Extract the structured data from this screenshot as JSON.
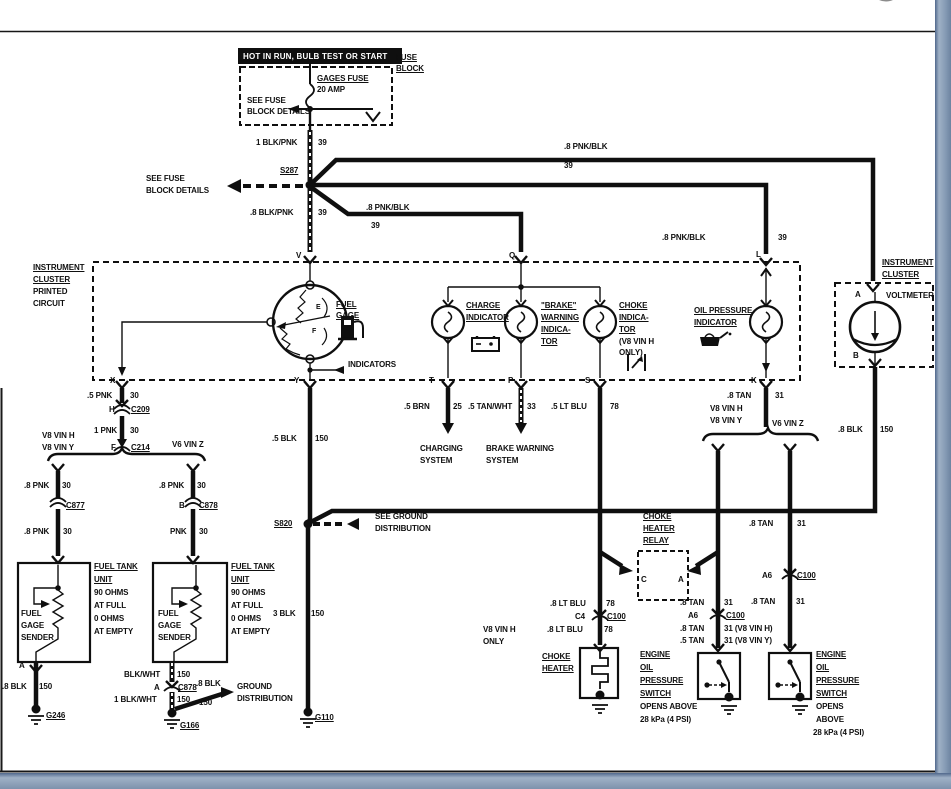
{
  "window": {
    "close_icon": "x-close-circle",
    "frame_accent_color": "#7d92ac",
    "frame_line_color": "#51688c"
  },
  "diagram": {
    "title": "HOT IN RUN, BULB TEST OR START",
    "ink_color": "#0f0f0f",
    "labels": [
      {
        "n": "banner-title",
        "t": "HOT IN RUN, BULB TEST OR START",
        "x": 243,
        "y": 52,
        "inv": true
      },
      {
        "n": "fuse-block-1",
        "t": "FUSE",
        "x": 396,
        "y": 53,
        "ul": true
      },
      {
        "n": "fuse-block-2",
        "t": "BLOCK",
        "x": 396,
        "y": 64,
        "ul": true
      },
      {
        "n": "gages-fuse",
        "t": "GAGES FUSE",
        "x": 317,
        "y": 74,
        "ul": true
      },
      {
        "n": "gages-fuse-amp",
        "t": "20 AMP",
        "x": 317,
        "y": 85
      },
      {
        "n": "see-fuse-a1",
        "t": "SEE FUSE",
        "x": 247,
        "y": 96
      },
      {
        "n": "see-fuse-a2",
        "t": "BLOCK DETAILS",
        "x": 247,
        "y": 107
      },
      {
        "n": "w-1blkpnk",
        "t": "1 BLK/PNK",
        "x": 256,
        "y": 138
      },
      {
        "n": "w-1blkpnk-ckt",
        "t": "39",
        "x": 318,
        "y": 138
      },
      {
        "n": "splice-s287",
        "t": "S287",
        "x": 280,
        "y": 166,
        "ul": true
      },
      {
        "n": "see-fuse-b1",
        "t": "SEE FUSE",
        "x": 146,
        "y": 174
      },
      {
        "n": "see-fuse-b2",
        "t": "BLOCK DETAILS",
        "x": 146,
        "y": 186
      },
      {
        "n": "w-8blkpnk",
        "t": ".8 BLK/PNK",
        "x": 250,
        "y": 208
      },
      {
        "n": "w-8blkpnk-ckt",
        "t": "39",
        "x": 318,
        "y": 208
      },
      {
        "n": "w-8pnkblk-top",
        "t": ".8 PNK/BLK",
        "x": 564,
        "y": 142
      },
      {
        "n": "w-8pnkblk-top-ckt",
        "t": "39",
        "x": 564,
        "y": 161
      },
      {
        "n": "w-8pnkblk-q",
        "t": ".8 PNK/BLK",
        "x": 366,
        "y": 203
      },
      {
        "n": "w-8pnkblk-q-ckt",
        "t": "39",
        "x": 371,
        "y": 221
      },
      {
        "n": "w-8pnkblk-l",
        "t": ".8 PNK/BLK",
        "x": 662,
        "y": 233
      },
      {
        "n": "w-8pnkblk-l-ckt",
        "t": "39",
        "x": 778,
        "y": 233
      },
      {
        "n": "ic-1",
        "t": "INSTRUMENT",
        "x": 33,
        "y": 263,
        "ul": true
      },
      {
        "n": "ic-2",
        "t": "CLUSTER",
        "x": 33,
        "y": 275,
        "ul": true
      },
      {
        "n": "ic-3",
        "t": "PRINTED",
        "x": 33,
        "y": 287
      },
      {
        "n": "ic-4",
        "t": "CIRCUIT",
        "x": 33,
        "y": 299
      },
      {
        "n": "term-v",
        "t": "V",
        "x": 296,
        "y": 251
      },
      {
        "n": "term-q",
        "t": "Q",
        "x": 509,
        "y": 251
      },
      {
        "n": "term-l",
        "t": "L",
        "x": 756,
        "y": 250
      },
      {
        "n": "fuel-gage-1",
        "t": "FUEL",
        "x": 336,
        "y": 300,
        "ul": true
      },
      {
        "n": "fuel-gage-2",
        "t": "GAGE",
        "x": 336,
        "y": 311,
        "ul": true
      },
      {
        "n": "gauge-e",
        "t": "E",
        "x": 316,
        "y": 303,
        "fs": 7
      },
      {
        "n": "gauge-f",
        "t": "F",
        "x": 312,
        "y": 327,
        "fs": 7
      },
      {
        "n": "indicators",
        "t": "INDICATORS",
        "x": 348,
        "y": 360
      },
      {
        "n": "charge-1",
        "t": "CHARGE",
        "x": 466,
        "y": 301,
        "ul": true
      },
      {
        "n": "charge-2",
        "t": "INDICATOR",
        "x": 466,
        "y": 313,
        "ul": true
      },
      {
        "n": "brake-1",
        "t": "\"BRAKE\"",
        "x": 541,
        "y": 301,
        "ul": true
      },
      {
        "n": "brake-2",
        "t": "WARNING",
        "x": 541,
        "y": 313,
        "ul": true
      },
      {
        "n": "brake-3",
        "t": "INDICA-",
        "x": 541,
        "y": 325,
        "ul": true
      },
      {
        "n": "brake-4",
        "t": "TOR",
        "x": 541,
        "y": 337,
        "ul": true
      },
      {
        "n": "choke-1",
        "t": "CHOKE",
        "x": 619,
        "y": 301,
        "ul": true
      },
      {
        "n": "choke-2",
        "t": "INDICA-",
        "x": 619,
        "y": 313,
        "ul": true
      },
      {
        "n": "choke-3",
        "t": "TOR",
        "x": 619,
        "y": 325,
        "ul": true
      },
      {
        "n": "choke-4",
        "t": "(V8 VIN H",
        "x": 619,
        "y": 337
      },
      {
        "n": "choke-5",
        "t": "ONLY)",
        "x": 619,
        "y": 348
      },
      {
        "n": "oilind-1",
        "t": "OIL PRESSURE",
        "x": 694,
        "y": 306,
        "ul": true
      },
      {
        "n": "oilind-2",
        "t": "INDICATOR",
        "x": 694,
        "y": 318,
        "ul": true
      },
      {
        "n": "ic-right-1",
        "t": "INSTRUMENT",
        "x": 882,
        "y": 258,
        "ul": true
      },
      {
        "n": "ic-right-2",
        "t": "CLUSTER",
        "x": 882,
        "y": 270,
        "ul": true
      },
      {
        "n": "volt-a",
        "t": "A",
        "x": 855,
        "y": 290
      },
      {
        "n": "voltmeter",
        "t": "VOLTMETER",
        "x": 886,
        "y": 291
      },
      {
        "n": "volt-b",
        "t": "B",
        "x": 853,
        "y": 351
      },
      {
        "n": "term-x",
        "t": "X",
        "x": 110,
        "y": 376
      },
      {
        "n": "term-y",
        "t": "Y",
        "x": 294,
        "y": 376
      },
      {
        "n": "term-t",
        "t": "T",
        "x": 429,
        "y": 376
      },
      {
        "n": "term-p",
        "t": "P",
        "x": 508,
        "y": 376
      },
      {
        "n": "term-s",
        "t": "S",
        "x": 585,
        "y": 376
      },
      {
        "n": "term-k",
        "t": "K",
        "x": 751,
        "y": 376
      },
      {
        "n": "w-5pnk",
        "t": ".5 PNK",
        "x": 87,
        "y": 391
      },
      {
        "n": "w-5pnk-ckt",
        "t": "30",
        "x": 130,
        "y": 391
      },
      {
        "n": "conn-h",
        "t": "H",
        "x": 109,
        "y": 405
      },
      {
        "n": "conn-c209",
        "t": "C209",
        "x": 131,
        "y": 405,
        "ul": true
      },
      {
        "n": "w-1pnk",
        "t": "1 PNK",
        "x": 94,
        "y": 426
      },
      {
        "n": "w-1pnk-ckt",
        "t": "30",
        "x": 130,
        "y": 426
      },
      {
        "n": "vin-l1",
        "t": "V8 VIN H",
        "x": 42,
        "y": 431
      },
      {
        "n": "vin-l2",
        "t": "V8 VIN Y",
        "x": 42,
        "y": 443
      },
      {
        "n": "conn-f",
        "t": "F",
        "x": 111,
        "y": 443
      },
      {
        "n": "conn-c214",
        "t": "C214",
        "x": 131,
        "y": 443,
        "ul": true
      },
      {
        "n": "vin-l3",
        "t": "V6 VIN Z",
        "x": 172,
        "y": 440
      },
      {
        "n": "w-8pnk-a",
        "t": ".8 PNK",
        "x": 24,
        "y": 481
      },
      {
        "n": "w-8pnk-a-ckt",
        "t": "30",
        "x": 62,
        "y": 481
      },
      {
        "n": "conn-c877",
        "t": "C877",
        "x": 66,
        "y": 501,
        "ul": true
      },
      {
        "n": "w-8pnk-b",
        "t": ".8 PNK",
        "x": 159,
        "y": 481
      },
      {
        "n": "w-8pnk-b-ckt",
        "t": "30",
        "x": 197,
        "y": 481
      },
      {
        "n": "conn-c878-b",
        "t": "B",
        "x": 179,
        "y": 501
      },
      {
        "n": "conn-c878",
        "t": "C878",
        "x": 199,
        "y": 501,
        "ul": true
      },
      {
        "n": "w-8pnk-c",
        "t": ".8 PNK",
        "x": 24,
        "y": 527
      },
      {
        "n": "w-8pnk-c-ckt",
        "t": "30",
        "x": 63,
        "y": 527
      },
      {
        "n": "w-pnk",
        "t": "PNK",
        "x": 170,
        "y": 527
      },
      {
        "n": "w-pnk-ckt",
        "t": "30",
        "x": 199,
        "y": 527
      },
      {
        "n": "ft1-1",
        "t": "FUEL TANK",
        "x": 94,
        "y": 562,
        "ul": true
      },
      {
        "n": "ft1-2",
        "t": "UNIT",
        "x": 94,
        "y": 575,
        "ul": true
      },
      {
        "n": "ft1-3",
        "t": "90 OHMS",
        "x": 94,
        "y": 588
      },
      {
        "n": "ft1-4",
        "t": "AT FULL",
        "x": 94,
        "y": 601
      },
      {
        "n": "ft1-5",
        "t": "0 OHMS",
        "x": 94,
        "y": 614
      },
      {
        "n": "ft1-6",
        "t": "AT EMPTY",
        "x": 94,
        "y": 627
      },
      {
        "n": "sender1-1",
        "t": "FUEL",
        "x": 21,
        "y": 609
      },
      {
        "n": "sender1-2",
        "t": "GAGE",
        "x": 21,
        "y": 621
      },
      {
        "n": "sender1-3",
        "t": "SENDER",
        "x": 21,
        "y": 633
      },
      {
        "n": "ft2-1",
        "t": "FUEL TANK",
        "x": 231,
        "y": 562,
        "ul": true
      },
      {
        "n": "ft2-2",
        "t": "UNIT",
        "x": 231,
        "y": 575,
        "ul": true
      },
      {
        "n": "ft2-3",
        "t": "90 OHMS",
        "x": 231,
        "y": 588
      },
      {
        "n": "ft2-4",
        "t": "AT FULL",
        "x": 231,
        "y": 601
      },
      {
        "n": "ft2-5",
        "t": "0 OHMS",
        "x": 231,
        "y": 614
      },
      {
        "n": "ft2-6",
        "t": "AT EMPTY",
        "x": 231,
        "y": 627
      },
      {
        "n": "sender2-1",
        "t": "FUEL",
        "x": 158,
        "y": 609
      },
      {
        "n": "sender2-2",
        "t": "GAGE",
        "x": 158,
        "y": 621
      },
      {
        "n": "sender2-3",
        "t": "SENDER",
        "x": 158,
        "y": 633
      },
      {
        "n": "term-a1",
        "t": "A",
        "x": 19,
        "y": 661
      },
      {
        "n": "w-8blk-l",
        "t": ".8 BLK",
        "x": 2,
        "y": 682
      },
      {
        "n": "w-8blk-l-ckt",
        "t": "150",
        "x": 39,
        "y": 682
      },
      {
        "n": "gnd-g246",
        "t": "G246",
        "x": 46,
        "y": 711,
        "ul": true
      },
      {
        "n": "w-blkwht",
        "t": "BLK/WHT",
        "x": 124,
        "y": 670
      },
      {
        "n": "w-blkwht-ckt",
        "t": "150",
        "x": 177,
        "y": 670
      },
      {
        "n": "conn-c878b-a",
        "t": "A",
        "x": 154,
        "y": 683
      },
      {
        "n": "conn-c878b",
        "t": "C878",
        "x": 178,
        "y": 683,
        "ul": true
      },
      {
        "n": "w-1blkwht",
        "t": "1 BLK/WHT",
        "x": 114,
        "y": 695
      },
      {
        "n": "w-1blkwht-ckt",
        "t": "150",
        "x": 177,
        "y": 695
      },
      {
        "n": "w-8blk-diag",
        "t": ".8 BLK",
        "x": 196,
        "y": 679
      },
      {
        "n": "w-8blk-diag-ckt",
        "t": "150",
        "x": 199,
        "y": 698
      },
      {
        "n": "gnd-dist-1",
        "t": "GROUND",
        "x": 237,
        "y": 682
      },
      {
        "n": "gnd-dist-2",
        "t": "DISTRIBUTION",
        "x": 237,
        "y": 694
      },
      {
        "n": "gnd-g166",
        "t": "G166",
        "x": 180,
        "y": 721,
        "ul": true
      },
      {
        "n": "w-5blk",
        "t": ".5 BLK",
        "x": 272,
        "y": 434
      },
      {
        "n": "w-5blk-ckt",
        "t": "150",
        "x": 315,
        "y": 434
      },
      {
        "n": "splice-s820",
        "t": "S820",
        "x": 274,
        "y": 519,
        "ul": true
      },
      {
        "n": "see-gnd-1",
        "t": "SEE GROUND",
        "x": 375,
        "y": 512
      },
      {
        "n": "see-gnd-2",
        "t": "DISTRIBUTION",
        "x": 375,
        "y": 524
      },
      {
        "n": "w-3blk",
        "t": "3 BLK",
        "x": 273,
        "y": 609
      },
      {
        "n": "w-3blk-ckt",
        "t": "150",
        "x": 311,
        "y": 609
      },
      {
        "n": "gnd-g110",
        "t": "G110",
        "x": 315,
        "y": 713,
        "ul": true
      },
      {
        "n": "w-5brn",
        "t": ".5 BRN",
        "x": 404,
        "y": 402
      },
      {
        "n": "w-5brn-ckt",
        "t": "25",
        "x": 453,
        "y": 402
      },
      {
        "n": "charging-1",
        "t": "CHARGING",
        "x": 420,
        "y": 444
      },
      {
        "n": "charging-2",
        "t": "SYSTEM",
        "x": 420,
        "y": 456
      },
      {
        "n": "w-5tanwht",
        "t": ".5 TAN/WHT",
        "x": 468,
        "y": 402
      },
      {
        "n": "w-5tanwht-ckt",
        "t": "33",
        "x": 527,
        "y": 402
      },
      {
        "n": "brakesys-1",
        "t": "BRAKE WARNING",
        "x": 486,
        "y": 444
      },
      {
        "n": "brakesys-2",
        "t": "SYSTEM",
        "x": 486,
        "y": 456
      },
      {
        "n": "w-5ltblu",
        "t": ".5 LT BLU",
        "x": 551,
        "y": 402
      },
      {
        "n": "w-5ltblu-ckt",
        "t": "78",
        "x": 610,
        "y": 402
      },
      {
        "n": "w-8tan-k",
        "t": ".8 TAN",
        "x": 727,
        "y": 391
      },
      {
        "n": "w-8tan-k-ckt",
        "t": "31",
        "x": 775,
        "y": 391
      },
      {
        "n": "vin-r1",
        "t": "V8 VIN H",
        "x": 710,
        "y": 404
      },
      {
        "n": "vin-r2",
        "t": "V8 VIN Y",
        "x": 710,
        "y": 416
      },
      {
        "n": "vin-r3",
        "t": "V6 VIN Z",
        "x": 772,
        "y": 419
      },
      {
        "n": "w-8blk-volt",
        "t": ".8 BLK",
        "x": 838,
        "y": 425
      },
      {
        "n": "w-8blk-volt-ckt",
        "t": "150",
        "x": 880,
        "y": 425
      },
      {
        "n": "w-8tan-r1",
        "t": ".8 TAN",
        "x": 749,
        "y": 519
      },
      {
        "n": "w-8tan-r1-ckt",
        "t": "31",
        "x": 797,
        "y": 519
      },
      {
        "n": "relay-1",
        "t": "CHOKE",
        "x": 643,
        "y": 512,
        "ul": true
      },
      {
        "n": "relay-2",
        "t": "HEATER",
        "x": 643,
        "y": 524,
        "ul": true
      },
      {
        "n": "relay-3",
        "t": "RELAY",
        "x": 643,
        "y": 536,
        "ul": true
      },
      {
        "n": "relay-c",
        "t": "C",
        "x": 641,
        "y": 575
      },
      {
        "n": "relay-a",
        "t": "A",
        "x": 678,
        "y": 575
      },
      {
        "n": "w-8ltblu-1",
        "t": ".8 LT BLU",
        "x": 550,
        "y": 599
      },
      {
        "n": "w-8ltblu-1-ckt",
        "t": "78",
        "x": 606,
        "y": 599
      },
      {
        "n": "conn-c4",
        "t": "C4",
        "x": 575,
        "y": 612
      },
      {
        "n": "conn-c100-c4",
        "t": "C100",
        "x": 607,
        "y": 612,
        "ul": true
      },
      {
        "n": "w-8ltblu-2",
        "t": ".8 LT BLU",
        "x": 547,
        "y": 625
      },
      {
        "n": "w-8ltblu-2-ckt",
        "t": "78",
        "x": 604,
        "y": 625
      },
      {
        "n": "v8only-1",
        "t": "V8 VIN H",
        "x": 483,
        "y": 625
      },
      {
        "n": "v8only-2",
        "t": "ONLY",
        "x": 483,
        "y": 637
      },
      {
        "n": "heater-1",
        "t": "CHOKE",
        "x": 542,
        "y": 652,
        "ul": true
      },
      {
        "n": "heater-2",
        "t": "HEATER",
        "x": 542,
        "y": 664,
        "ul": true
      },
      {
        "n": "w-8tan-m1",
        "t": ".8 TAN",
        "x": 680,
        "y": 598
      },
      {
        "n": "w-8tan-m1-ckt",
        "t": "31",
        "x": 724,
        "y": 598
      },
      {
        "n": "conn-a6-m",
        "t": "A6",
        "x": 688,
        "y": 611
      },
      {
        "n": "conn-c100-m",
        "t": "C100",
        "x": 726,
        "y": 611,
        "ul": true
      },
      {
        "n": "w-8tan-m2",
        "t": ".8 TAN",
        "x": 680,
        "y": 624
      },
      {
        "n": "w-8tan-m2-ckt",
        "t": "31 (V8 VIN H)",
        "x": 724,
        "y": 624
      },
      {
        "n": "w-5tan-m",
        "t": ".5 TAN",
        "x": 680,
        "y": 636
      },
      {
        "n": "w-5tan-m-ckt",
        "t": "31 (V8 VIN Y)",
        "x": 724,
        "y": 636
      },
      {
        "n": "conn-a6-r",
        "t": "A6",
        "x": 762,
        "y": 571
      },
      {
        "n": "conn-c100-r",
        "t": "C100",
        "x": 797,
        "y": 571,
        "ul": true
      },
      {
        "n": "w-8tan-r2",
        "t": ".8 TAN",
        "x": 751,
        "y": 597
      },
      {
        "n": "w-8tan-r2-ckt",
        "t": "31",
        "x": 796,
        "y": 597
      },
      {
        "n": "sw1-1",
        "t": "ENGINE",
        "x": 640,
        "y": 650,
        "ul": true
      },
      {
        "n": "sw1-2",
        "t": "OIL",
        "x": 640,
        "y": 663,
        "ul": true
      },
      {
        "n": "sw1-3",
        "t": "PRESSURE",
        "x": 640,
        "y": 676,
        "ul": true
      },
      {
        "n": "sw1-4",
        "t": "SWITCH",
        "x": 640,
        "y": 689,
        "ul": true
      },
      {
        "n": "sw1-5",
        "t": "OPENS ABOVE",
        "x": 640,
        "y": 702
      },
      {
        "n": "sw1-6",
        "t": "28 kPa (4 PSI)",
        "x": 640,
        "y": 715
      },
      {
        "n": "sw2-1",
        "t": "ENGINE",
        "x": 816,
        "y": 650,
        "ul": true
      },
      {
        "n": "sw2-2",
        "t": "OIL",
        "x": 816,
        "y": 663,
        "ul": true
      },
      {
        "n": "sw2-3",
        "t": "PRESSURE",
        "x": 816,
        "y": 676,
        "ul": true
      },
      {
        "n": "sw2-4",
        "t": "SWITCH",
        "x": 816,
        "y": 689,
        "ul": true
      },
      {
        "n": "sw2-5",
        "t": "OPENS",
        "x": 816,
        "y": 702
      },
      {
        "n": "sw2-6",
        "t": "ABOVE",
        "x": 816,
        "y": 715
      },
      {
        "n": "sw2-7",
        "t": "28 kPa (4 PSI)",
        "x": 813,
        "y": 728
      }
    ]
  }
}
